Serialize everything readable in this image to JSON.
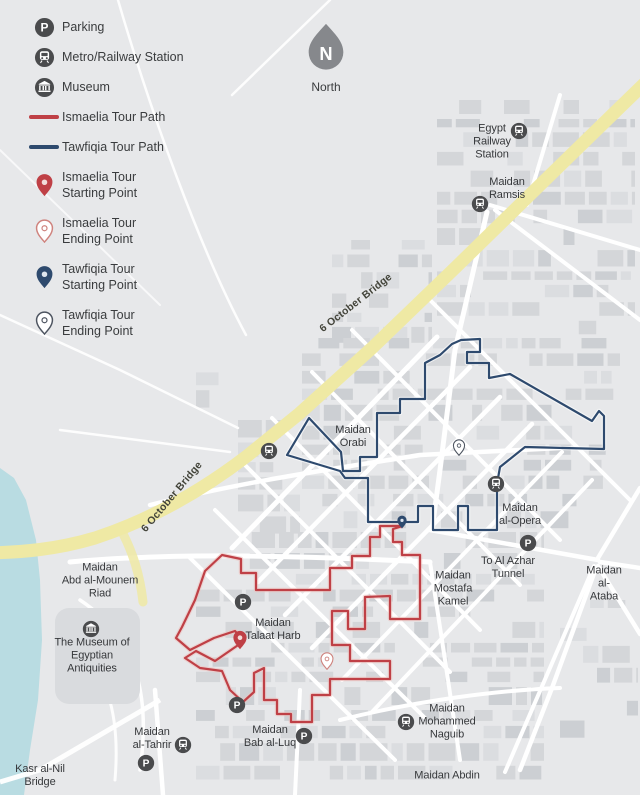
{
  "colors": {
    "ismaelia": "#bf4046",
    "ismaelia_outline": "#cf837e",
    "tawfiqia": "#2e4a6e",
    "tawfiqia_outline": "#4d5460",
    "bridge": "#efe9a4",
    "river": "#b9dce2",
    "icon": "#4a4b4d",
    "north": "#86888c"
  },
  "north": {
    "label": "North"
  },
  "legend": {
    "items": [
      {
        "name": "parking",
        "type": "icon-parking",
        "label": "Parking"
      },
      {
        "name": "metro",
        "type": "icon-metro",
        "label": "Metro/Railway Station"
      },
      {
        "name": "museum",
        "type": "icon-museum",
        "label": "Museum"
      },
      {
        "name": "ismaelia-path",
        "type": "swatch-red",
        "label": "Ismaelia Tour Path"
      },
      {
        "name": "tawfiqia-path",
        "type": "swatch-blue",
        "label": "Tawfiqia Tour Path"
      },
      {
        "name": "ismaelia-start",
        "type": "pin-red-start",
        "label": "Ismaelia Tour\nStarting Point"
      },
      {
        "name": "ismaelia-end",
        "type": "pin-red-end",
        "label": "Ismaelia Tour\nEnding Point"
      },
      {
        "name": "tawfiqia-start",
        "type": "pin-blue-start",
        "label": "Tawfiqia Tour\nStarting Point"
      },
      {
        "name": "tawfiqia-end",
        "type": "pin-blue-end",
        "label": "Tawfiqia Tour\nEnding Point"
      }
    ]
  },
  "map": {
    "labels": [
      {
        "name": "egypt-railway-station",
        "text": "Egypt\nRailway\nStation",
        "x": 492,
        "y": 142
      },
      {
        "name": "maidan-ramsis",
        "text": "Maidan\nRamsis",
        "x": 507,
        "y": 189
      },
      {
        "name": "bridge-label-upper",
        "text": "6 October Bridge",
        "x": 356,
        "y": 303,
        "rot": -38,
        "cls": "bridge-label"
      },
      {
        "name": "bridge-label-lower",
        "text": "6 October Bridge",
        "x": 172,
        "y": 497,
        "rot": -50,
        "cls": "bridge-label"
      },
      {
        "name": "maidan-orabi",
        "text": "Maidan\nOrabi",
        "x": 353,
        "y": 437
      },
      {
        "name": "maidan-al-opera",
        "text": "Maidan\nal-Opera",
        "x": 520,
        "y": 515
      },
      {
        "name": "to-al-azhar-tunnel",
        "text": "To Al Azhar\nTunnel",
        "x": 508,
        "y": 568
      },
      {
        "name": "maidan-mostafa-kamel",
        "text": "Maidan\nMostafa\nKamel",
        "x": 453,
        "y": 589
      },
      {
        "name": "maidan-al-ataba",
        "text": "Maidan\nal-Ataba",
        "x": 604,
        "y": 584
      },
      {
        "name": "maidan-abd-al-mounem-riad",
        "text": "Maidan\nAbd al-Mounem\nRiad",
        "x": 100,
        "y": 581
      },
      {
        "name": "museum-of-egyptian-antiquities",
        "text": "The Museum of\nEgyptian\nAntiquities",
        "x": 92,
        "y": 656
      },
      {
        "name": "maidan-talaat-harb",
        "text": "Maidan\nTalaat Harb",
        "x": 273,
        "y": 630
      },
      {
        "name": "maidan-al-tahrir",
        "text": "Maidan\nal-Tahrir",
        "x": 152,
        "y": 739
      },
      {
        "name": "maidan-bab-al-luq",
        "text": "Maidan\nBab al-Luq",
        "x": 270,
        "y": 737
      },
      {
        "name": "maidan-mohammed-naguib",
        "text": "Maidan\nMohammed\nNaguib",
        "x": 447,
        "y": 722
      },
      {
        "name": "maidan-abdin",
        "text": "Maidan Abdin",
        "x": 447,
        "y": 776
      },
      {
        "name": "kasr-al-nil-bridge",
        "text": "Kasr al-Nil\nBridge",
        "x": 40,
        "y": 776
      }
    ],
    "markers": [
      {
        "type": "metro",
        "x": 519,
        "y": 131
      },
      {
        "type": "metro",
        "x": 480,
        "y": 204
      },
      {
        "type": "metro",
        "x": 269,
        "y": 451
      },
      {
        "type": "metro",
        "x": 496,
        "y": 484
      },
      {
        "type": "metro",
        "x": 183,
        "y": 745
      },
      {
        "type": "metro",
        "x": 406,
        "y": 722
      },
      {
        "type": "parking",
        "x": 528,
        "y": 543
      },
      {
        "type": "parking",
        "x": 243,
        "y": 602
      },
      {
        "type": "parking",
        "x": 237,
        "y": 705
      },
      {
        "type": "parking",
        "x": 304,
        "y": 736
      },
      {
        "type": "parking",
        "x": 146,
        "y": 763
      },
      {
        "type": "museum",
        "x": 91,
        "y": 629
      }
    ],
    "pins": [
      {
        "name": "ismaelia-start",
        "kind": "red-start",
        "x": 240,
        "y": 650,
        "h": 20
      },
      {
        "name": "ismaelia-end",
        "kind": "red-end",
        "x": 327,
        "y": 670,
        "h": 18
      },
      {
        "name": "tawfiqia-start",
        "kind": "blue-start",
        "x": 402,
        "y": 529,
        "h": 14
      },
      {
        "name": "tawfiqia-end",
        "kind": "blue-end",
        "x": 459,
        "y": 456,
        "h": 17
      }
    ],
    "paths": {
      "ismaelia": {
        "points": [
          [
            403,
            526
          ],
          [
            380,
            526
          ],
          [
            380,
            537
          ],
          [
            370,
            537
          ],
          [
            370,
            556
          ],
          [
            352,
            556
          ],
          [
            352,
            568
          ],
          [
            330,
            568
          ],
          [
            330,
            590
          ],
          [
            256,
            590
          ],
          [
            256,
            573
          ],
          [
            241,
            573
          ],
          [
            241,
            559
          ],
          [
            222,
            555
          ],
          [
            205,
            571
          ],
          [
            195,
            600
          ],
          [
            182,
            627
          ],
          [
            176,
            638
          ],
          [
            190,
            650
          ],
          [
            214,
            638
          ],
          [
            235,
            631
          ],
          [
            244,
            641
          ],
          [
            215,
            661
          ],
          [
            196,
            651
          ],
          [
            185,
            658
          ],
          [
            200,
            668
          ],
          [
            222,
            671
          ],
          [
            230,
            690
          ],
          [
            243,
            702
          ],
          [
            254,
            692
          ],
          [
            254,
            673
          ],
          [
            264,
            668
          ],
          [
            264,
            700
          ],
          [
            277,
            700
          ],
          [
            277,
            714
          ],
          [
            291,
            714
          ],
          [
            291,
            722
          ],
          [
            312,
            722
          ],
          [
            312,
            695
          ],
          [
            330,
            695
          ],
          [
            330,
            679
          ],
          [
            390,
            679
          ],
          [
            390,
            661
          ],
          [
            350,
            661
          ],
          [
            350,
            645
          ],
          [
            332,
            645
          ],
          [
            332,
            611
          ],
          [
            348,
            611
          ],
          [
            348,
            629
          ],
          [
            365,
            629
          ],
          [
            365,
            597
          ],
          [
            390,
            596
          ],
          [
            390,
            619
          ],
          [
            420,
            619
          ],
          [
            420,
            555
          ],
          [
            402,
            555
          ],
          [
            402,
            542
          ],
          [
            393,
            542
          ],
          [
            393,
            529
          ],
          [
            403,
            526
          ]
        ]
      },
      "tawfiqia": {
        "points": [
          [
            403,
            522
          ],
          [
            368,
            522
          ],
          [
            368,
            478
          ],
          [
            345,
            478
          ],
          [
            340,
            471
          ],
          [
            287,
            455
          ],
          [
            309,
            418
          ],
          [
            341,
            452
          ],
          [
            343,
            471
          ],
          [
            360,
            471
          ],
          [
            360,
            457
          ],
          [
            377,
            457
          ],
          [
            377,
            413
          ],
          [
            400,
            413
          ],
          [
            400,
            399
          ],
          [
            425,
            399
          ],
          [
            425,
            363
          ],
          [
            440,
            355
          ],
          [
            452,
            344
          ],
          [
            461,
            340
          ],
          [
            480,
            339
          ],
          [
            480,
            352
          ],
          [
            467,
            352
          ],
          [
            467,
            363
          ],
          [
            489,
            363
          ],
          [
            489,
            378
          ],
          [
            510,
            374
          ],
          [
            592,
            421
          ],
          [
            599,
            411
          ],
          [
            604,
            416
          ],
          [
            604,
            449
          ],
          [
            525,
            447
          ],
          [
            500,
            467
          ],
          [
            497,
            484
          ],
          [
            497,
            530
          ],
          [
            468,
            530
          ],
          [
            468,
            506
          ],
          [
            458,
            506
          ],
          [
            458,
            530
          ],
          [
            433,
            530
          ],
          [
            433,
            506
          ],
          [
            418,
            506
          ],
          [
            418,
            522
          ],
          [
            403,
            522
          ]
        ]
      }
    }
  }
}
